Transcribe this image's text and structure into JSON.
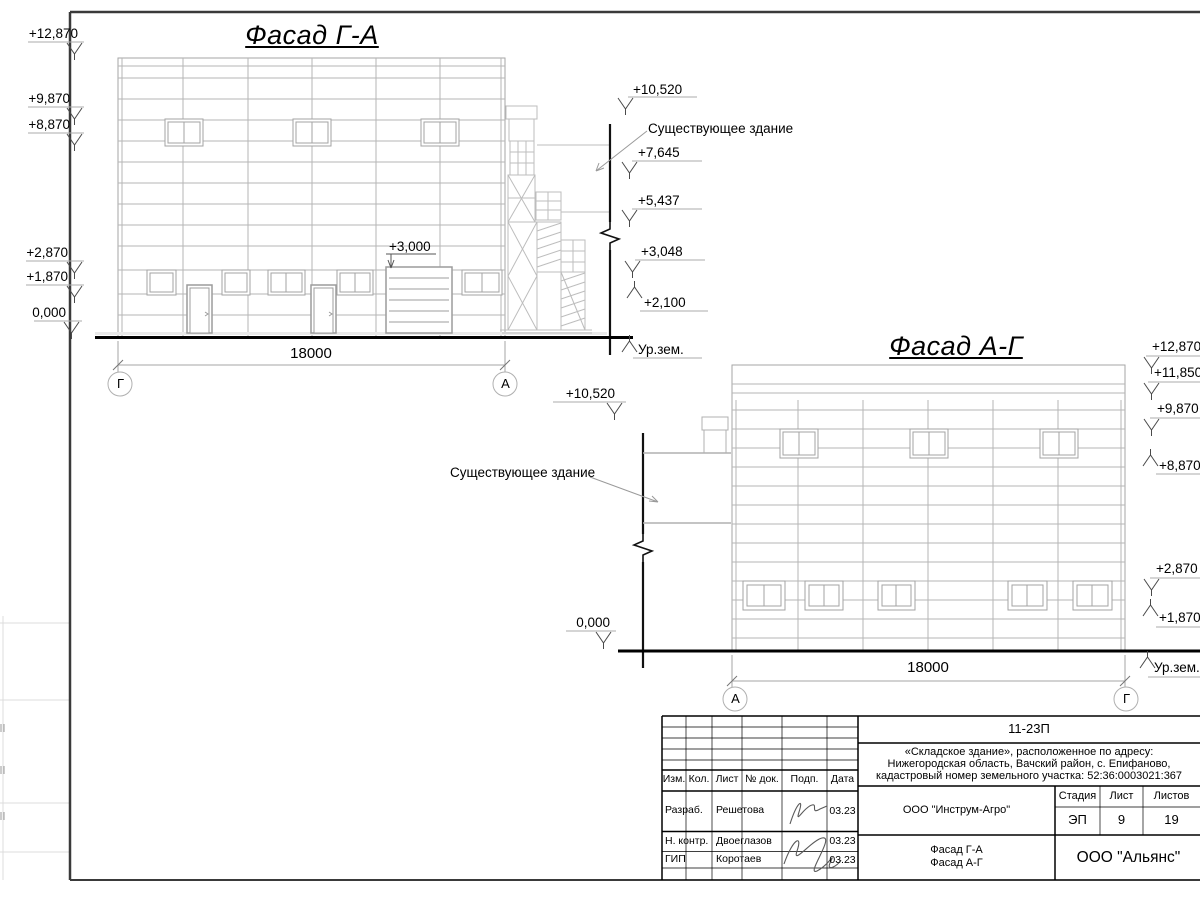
{
  "colors": {
    "line_dark": "#1a1a1a",
    "line_gray": "#b6b6b6",
    "paper": "#ffffff"
  },
  "facade1": {
    "title": "Фасад Г-А",
    "dimension": "18000",
    "axes": {
      "left": "Г",
      "right": "А"
    },
    "marks": {
      "m12870": "+12,870",
      "m9870": "+9,870",
      "m8870": "+8,870",
      "m2870": "+2,870",
      "m1870": "+1,870",
      "m0": "0,000",
      "m10520": "+10,520",
      "m7645": "+7,645",
      "m5437": "+5,437",
      "m3048": "+3,048",
      "m2100": "+2,100",
      "m3000": "+3,000"
    },
    "existing_building": "Существующее здание",
    "ground_level": "Ур.зем."
  },
  "facade2": {
    "title": "Фасад А-Г",
    "dimension": "18000",
    "axes": {
      "left": "А",
      "right": "Г"
    },
    "marks": {
      "m12870": "+12,870",
      "m11850": "+11,850",
      "m9870": "+9,870",
      "m8870": "+8,870",
      "m2870": "+2,870",
      "m1870": "+1,870",
      "m10520": "+10,520",
      "m0": "0,000"
    },
    "existing_building": "Существующее здание",
    "ground_level": "Ур.зем."
  },
  "title_block": {
    "doc_number": "11-23П",
    "project_line1": "«Складское здание», расположенное по адресу:",
    "project_line2": "Нижегородская область, Вачский район, с. Епифаново,",
    "project_line3": "кадастровый номер земельного участка: 52:36:0003021:367",
    "headers": {
      "izm": "Изм.",
      "kol": "Кол.",
      "list": "Лист",
      "doc": "№ док.",
      "podp": "Подп.",
      "data": "Дата"
    },
    "rows": [
      {
        "role": "Разраб.",
        "name": "Решетова",
        "date": "03.23"
      },
      {
        "role": "Н. контр.",
        "name": "Двоеглазов",
        "date": "03.23"
      },
      {
        "role": "ГИП",
        "name": "Коротаев",
        "date": "03.23"
      }
    ],
    "company": "ООО \"Инструм-Агро\"",
    "stage_header": "Стадия",
    "sheet_header": "Лист",
    "sheets_header": "Листов",
    "stage": "ЭП",
    "sheet": "9",
    "sheets": "19",
    "drawing_title_line1": "Фасад Г-А",
    "drawing_title_line2": "Фасад А-Г",
    "contractor": "ООО \"Альянс\""
  }
}
